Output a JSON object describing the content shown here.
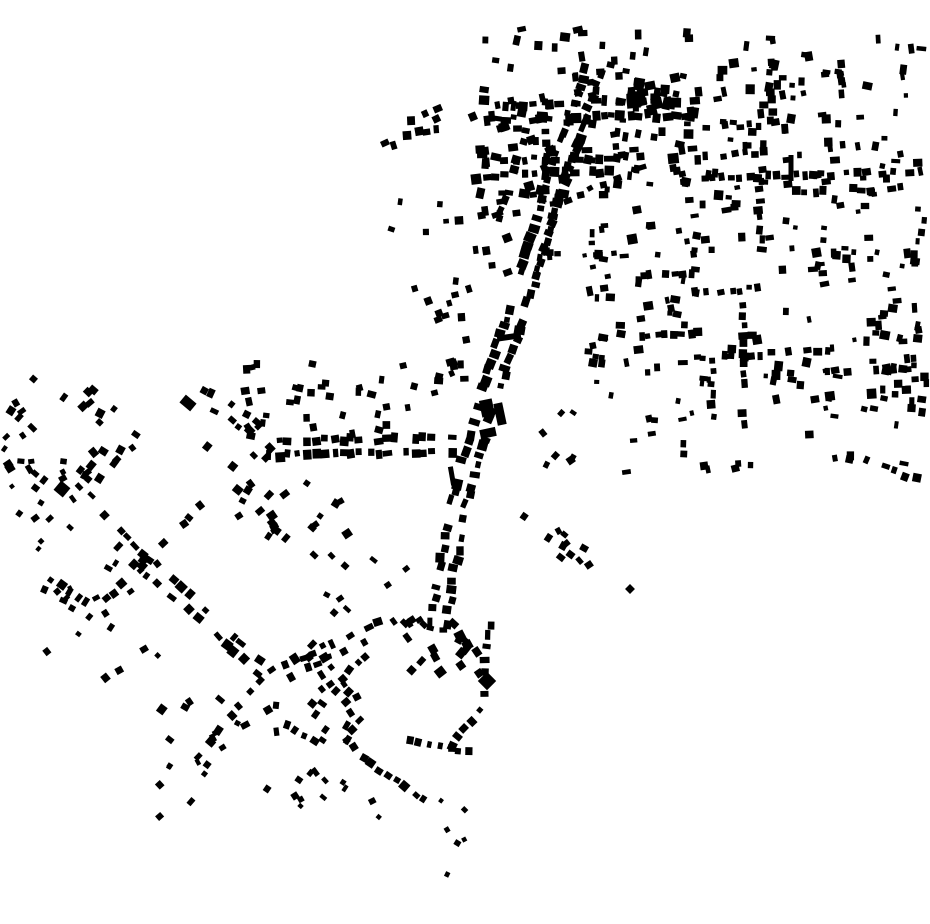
{
  "canvas": {
    "width": 930,
    "height": 924,
    "background_color": "#ffffff",
    "building_color": "#000000"
  },
  "map_type": "building-footprint-figure-ground",
  "seed": 42,
  "streets": [
    {
      "name": "main-road-1",
      "p": [
        594,
        66,
        565,
        152
      ],
      "gap": 9.5,
      "off": 8,
      "oj": 2.5,
      "sides": 2,
      "size": [
        5,
        11
      ],
      "aj": 9,
      "skip": 0.12
    },
    {
      "name": "main-road-2",
      "p": [
        565,
        152,
        524,
        288
      ],
      "gap": 9.5,
      "off": 8,
      "oj": 2.5,
      "sides": 2,
      "size": [
        5,
        11
      ],
      "aj": 9,
      "skip": 0.12
    },
    {
      "name": "main-road-3",
      "p": [
        524,
        288,
        487,
        402
      ],
      "gap": 9.5,
      "off": 8,
      "oj": 2.5,
      "sides": 2,
      "size": [
        5,
        11
      ],
      "aj": 9,
      "skip": 0.12
    },
    {
      "name": "main-road-4",
      "p": [
        487,
        402,
        456,
        512
      ],
      "gap": 10,
      "off": 8,
      "oj": 2.5,
      "sides": 2,
      "size": [
        5,
        11
      ],
      "aj": 9,
      "skip": 0.14
    },
    {
      "name": "main-road-5",
      "p": [
        456,
        512,
        436,
        645
      ],
      "gap": 10.5,
      "off": 7.5,
      "oj": 2.5,
      "sides": 2,
      "size": [
        5,
        10
      ],
      "aj": 9,
      "skip": 0.18
    },
    {
      "name": "parallel-road-east",
      "p": [
        588,
        132,
        537,
        298
      ],
      "gap": 12,
      "off": 7,
      "oj": 2,
      "sides": 1,
      "size": [
        5,
        10
      ],
      "aj": 10,
      "skip": 0.28
    },
    {
      "name": "parallel-road-west",
      "p": [
        533,
        130,
        503,
        228
      ],
      "gap": 10,
      "off": 6,
      "oj": 2,
      "sides": 1,
      "size": [
        5,
        9
      ],
      "aj": 10,
      "skip": 0.25
    },
    {
      "name": "branch-northeast",
      "p": [
        560,
        196,
        648,
        160
      ],
      "gap": 13,
      "off": 6,
      "oj": 2,
      "sides": 1,
      "size": [
        5,
        9
      ],
      "aj": 10,
      "skip": 0.3
    },
    {
      "name": "top-row-1",
      "p": [
        482,
        112,
        700,
        108
      ],
      "gap": 9,
      "off": 7,
      "oj": 2.5,
      "sides": 2,
      "size": [
        5,
        11
      ],
      "aj": 10,
      "skip": 0.22
    },
    {
      "name": "top-row-2",
      "p": [
        482,
        168,
        622,
        164
      ],
      "gap": 9.5,
      "off": 7,
      "oj": 2.5,
      "sides": 2,
      "size": [
        5,
        10
      ],
      "aj": 10,
      "skip": 0.25
    },
    {
      "name": "ne-row-1",
      "p": [
        703,
        123,
        762,
        119
      ],
      "gap": 8.5,
      "off": 5,
      "oj": 2,
      "sides": 1,
      "size": [
        4,
        8
      ],
      "aj": 8,
      "skip": 0.1
    },
    {
      "name": "ne-row-2",
      "p": [
        700,
        151,
        772,
        147
      ],
      "gap": 10,
      "off": 5,
      "oj": 2,
      "sides": 1,
      "size": [
        5,
        9
      ],
      "aj": 8,
      "skip": 0.25
    },
    {
      "name": "ne-row-long",
      "p": [
        700,
        172,
        928,
        166
      ],
      "gap": 9,
      "off": 6,
      "oj": 2,
      "sides": 1,
      "size": [
        5,
        9
      ],
      "aj": 8,
      "skip": 0.18
    },
    {
      "name": "ne-row-3",
      "p": [
        790,
        187,
        908,
        183
      ],
      "gap": 9.5,
      "off": 5,
      "oj": 2,
      "sides": 1,
      "size": [
        5,
        9
      ],
      "aj": 8,
      "skip": 0.25
    },
    {
      "name": "e-row-1",
      "p": [
        637,
        271,
        704,
        267
      ],
      "gap": 8.5,
      "off": 5,
      "oj": 2,
      "sides": 1,
      "size": [
        5,
        9
      ],
      "aj": 8,
      "skip": 0.12
    },
    {
      "name": "e-row-2",
      "p": [
        718,
        286,
        764,
        283
      ],
      "gap": 9,
      "off": 5,
      "oj": 2,
      "sides": 1,
      "size": [
        5,
        9
      ],
      "aj": 8,
      "skip": 0.2
    },
    {
      "name": "e-row-3",
      "p": [
        636,
        331,
        708,
        328
      ],
      "gap": 8.5,
      "off": 5,
      "oj": 2,
      "sides": 1,
      "size": [
        5,
        9
      ],
      "aj": 8,
      "skip": 0.12
    },
    {
      "name": "e-row-4",
      "p": [
        700,
        352,
        850,
        345
      ],
      "gap": 9.5,
      "off": 5,
      "oj": 2,
      "sides": 1,
      "size": [
        5,
        9
      ],
      "aj": 8,
      "skip": 0.3
    },
    {
      "name": "e-row-5",
      "p": [
        820,
        368,
        928,
        361
      ],
      "gap": 10,
      "off": 5,
      "oj": 2,
      "sides": 1,
      "size": [
        5,
        9
      ],
      "aj": 8,
      "skip": 0.35
    },
    {
      "name": "se-diagonal",
      "p": [
        852,
        450,
        928,
        478
      ],
      "gap": 10.5,
      "off": 5,
      "oj": 2,
      "sides": 1,
      "size": [
        5,
        9
      ],
      "aj": 10,
      "skip": 0.2
    },
    {
      "name": "ne-col-1",
      "p": [
        776,
        58,
        776,
        132
      ],
      "gap": 9.5,
      "off": 5,
      "oj": 2,
      "sides": 1,
      "size": [
        5,
        9
      ],
      "aj": 8,
      "skip": 0.2
    },
    {
      "name": "ne-col-2",
      "p": [
        766,
        166,
        766,
        242
      ],
      "gap": 9.5,
      "off": 5,
      "oj": 2,
      "sides": 1,
      "size": [
        5,
        9
      ],
      "aj": 8,
      "skip": 0.2
    },
    {
      "name": "e-col-1",
      "p": [
        748,
        300,
        748,
        438
      ],
      "gap": 10,
      "off": 5,
      "oj": 2,
      "sides": 1,
      "size": [
        5,
        9
      ],
      "aj": 8,
      "skip": 0.25
    },
    {
      "name": "e-col-2",
      "p": [
        718,
        346,
        718,
        430
      ],
      "gap": 10.5,
      "off": 5,
      "oj": 2,
      "sides": 1,
      "size": [
        5,
        9
      ],
      "aj": 8,
      "skip": 0.3
    },
    {
      "name": "ne-col-3",
      "p": [
        845,
        58,
        845,
        133
      ],
      "gap": 10,
      "off": 5,
      "oj": 2,
      "sides": 1,
      "size": [
        5,
        9
      ],
      "aj": 8,
      "skip": 0.3
    },
    {
      "name": "e-edge-col",
      "p": [
        920,
        205,
        920,
        284
      ],
      "gap": 11,
      "off": 4,
      "oj": 2,
      "sides": 1,
      "size": [
        4,
        8
      ],
      "aj": 8,
      "skip": 0.3
    },
    {
      "name": "sw-main-diagonal",
      "p": [
        95,
        518,
        272,
        678
      ],
      "gap": 10.5,
      "off": 6.5,
      "oj": 2,
      "sides": 2,
      "size": [
        5,
        10
      ],
      "aj": 10,
      "skip": 0.2
    },
    {
      "name": "sw-cross-street",
      "p": [
        208,
        508,
        92,
        622
      ],
      "gap": 12,
      "off": 6,
      "oj": 2,
      "sides": 1,
      "size": [
        5,
        9
      ],
      "aj": 10,
      "skip": 0.3
    },
    {
      "name": "sw-short-street",
      "p": [
        44,
        582,
        98,
        617
      ],
      "gap": 10.5,
      "off": 6,
      "oj": 2,
      "sides": 2,
      "size": [
        5,
        9
      ],
      "aj": 10,
      "skip": 0.3
    },
    {
      "name": "sw-arm-northeast",
      "p": [
        272,
        678,
        395,
        620
      ],
      "gap": 10.5,
      "off": 6,
      "oj": 2,
      "sides": 2,
      "size": [
        5,
        10
      ],
      "aj": 10,
      "skip": 0.3
    },
    {
      "name": "sw-arm-south",
      "p": [
        268,
        682,
        196,
        768
      ],
      "gap": 11,
      "off": 6,
      "oj": 2,
      "sides": 1,
      "size": [
        5,
        9
      ],
      "aj": 10,
      "skip": 0.25
    },
    {
      "name": "sw-arm-down",
      "p": [
        279,
        700,
        283,
        758
      ],
      "gap": 12,
      "off": 5,
      "oj": 2,
      "sides": 1,
      "size": [
        5,
        9
      ],
      "aj": 12,
      "skip": 0.3
    },
    {
      "name": "sw-x-street-a",
      "p": [
        303,
        642,
        362,
        715
      ],
      "gap": 11,
      "off": 6,
      "oj": 2,
      "sides": 2,
      "size": [
        5,
        9
      ],
      "aj": 10,
      "skip": 0.35
    },
    {
      "name": "sw-x-street-b",
      "p": [
        306,
        714,
        365,
        645
      ],
      "gap": 11,
      "off": 6,
      "oj": 2,
      "sides": 1,
      "size": [
        5,
        9
      ],
      "aj": 10,
      "skip": 0.3
    },
    {
      "name": "sw-arm-southeast",
      "p": [
        285,
        718,
        350,
        752
      ],
      "gap": 11,
      "off": 5,
      "oj": 2,
      "sides": 1,
      "size": [
        5,
        9
      ],
      "aj": 10,
      "skip": 0.3
    },
    {
      "name": "midleft-street-a",
      "p": [
        196,
        390,
        262,
        434
      ],
      "gap": 10.5,
      "off": 6,
      "oj": 2,
      "sides": 2,
      "size": [
        5,
        9
      ],
      "aj": 10,
      "skip": 0.3
    },
    {
      "name": "midleft-street-b",
      "p": [
        235,
        480,
        318,
        562
      ],
      "gap": 12,
      "off": 6,
      "oj": 2,
      "sides": 1,
      "size": [
        5,
        9
      ],
      "aj": 10,
      "skip": 0.3
    },
    {
      "name": "central-horizontal-street",
      "p": [
        266,
        449,
        458,
        444
      ],
      "gap": 9,
      "off": 7,
      "oj": 2.5,
      "sides": 2,
      "size": [
        5,
        10
      ],
      "aj": 8,
      "skip": 0.15
    },
    {
      "name": "south-tail-1",
      "p": [
        497,
        618,
        487,
        708
      ],
      "gap": 12,
      "off": 6,
      "oj": 2,
      "sides": 1,
      "size": [
        5,
        10
      ],
      "aj": 12,
      "skip": 0.2
    },
    {
      "name": "south-tail-2",
      "p": [
        487,
        708,
        452,
        758
      ],
      "gap": 12,
      "off": 6,
      "oj": 2,
      "sides": 1,
      "size": [
        5,
        9
      ],
      "aj": 12,
      "skip": 0.25
    },
    {
      "name": "south-row",
      "p": [
        406,
        736,
        476,
        748
      ],
      "gap": 10,
      "off": 5,
      "oj": 2,
      "sides": 1,
      "size": [
        4,
        8
      ],
      "aj": 12,
      "skip": 0.25
    },
    {
      "name": "south-diagonal",
      "p": [
        362,
        750,
        430,
        800
      ],
      "gap": 10.5,
      "off": 5,
      "oj": 2,
      "sides": 1,
      "size": [
        5,
        9
      ],
      "aj": 10,
      "skip": 0.25
    },
    {
      "name": "southeast-spur",
      "p": [
        523,
        507,
        594,
        566
      ],
      "gap": 12,
      "off": 6,
      "oj": 2,
      "sides": 1,
      "size": [
        5,
        8
      ],
      "aj": 12,
      "skip": 0.3
    },
    {
      "name": "west-small-row",
      "p": [
        16,
        458,
        92,
        455
      ],
      "gap": 11,
      "off": 4,
      "oj": 2,
      "sides": 1,
      "size": [
        4,
        8
      ],
      "aj": 14,
      "skip": 0.2
    }
  ],
  "fields": [
    {
      "name": "top-scatter",
      "box": [
        470,
        28,
        245,
        68
      ],
      "n": 34,
      "size": [
        5,
        10
      ],
      "a": 0,
      "aj": 14
    },
    {
      "name": "top-cluster-infill",
      "box": [
        474,
        94,
        236,
        110
      ],
      "n": 48,
      "size": [
        5,
        11
      ],
      "a": 0,
      "aj": 14
    },
    {
      "name": "top-dense-blob",
      "box": [
        627,
        80,
        44,
        38
      ],
      "n": 16,
      "size": [
        6,
        12
      ],
      "a": 0,
      "aj": 14
    },
    {
      "name": "nw-outlier-cluster",
      "box": [
        376,
        106,
        62,
        46
      ],
      "n": 10,
      "size": [
        5,
        9
      ],
      "a": -15,
      "aj": 14
    },
    {
      "name": "nw-sparse-dots",
      "box": [
        372,
        195,
        88,
        95
      ],
      "n": 7,
      "size": [
        4,
        8
      ],
      "a": 0,
      "aj": 20
    },
    {
      "name": "right-field-upper",
      "box": [
        588,
        36,
        340,
        222
      ],
      "n": 150,
      "size": [
        4,
        10
      ],
      "a": 0,
      "aj": 12
    },
    {
      "name": "right-field-mid",
      "box": [
        588,
        258,
        340,
        145
      ],
      "n": 105,
      "size": [
        4,
        10
      ],
      "a": 0,
      "aj": 12
    },
    {
      "name": "right-field-lower",
      "box": [
        620,
        403,
        308,
        70
      ],
      "n": 26,
      "size": [
        4,
        9
      ],
      "a": 0,
      "aj": 15
    },
    {
      "name": "right-edge-cluster",
      "box": [
        880,
        338,
        50,
        58
      ],
      "n": 12,
      "size": [
        5,
        9
      ],
      "a": 5,
      "aj": 12
    },
    {
      "name": "road-west-upper",
      "box": [
        468,
        92,
        92,
        122
      ],
      "n": 26,
      "size": [
        5,
        10
      ],
      "a": -12,
      "aj": 12
    },
    {
      "name": "road-west-shoulder",
      "box": [
        458,
        215,
        50,
        82
      ],
      "n": 10,
      "size": [
        5,
        9
      ],
      "a": -12,
      "aj": 12
    },
    {
      "name": "road-east-sparse",
      "box": [
        545,
        210,
        58,
        82
      ],
      "n": 8,
      "size": [
        4,
        8
      ],
      "a": -10,
      "aj": 12
    },
    {
      "name": "road-west-mid",
      "box": [
        424,
        292,
        64,
        90
      ],
      "n": 14,
      "size": [
        5,
        9
      ],
      "a": -12,
      "aj": 12
    },
    {
      "name": "road-east-dots",
      "box": [
        532,
        412,
        54,
        60
      ],
      "n": 7,
      "size": [
        4,
        8
      ],
      "a": 45,
      "aj": 20
    },
    {
      "name": "spur-end-cluster",
      "box": [
        548,
        520,
        44,
        46
      ],
      "n": 6,
      "size": [
        5,
        8
      ],
      "a": 45,
      "aj": 18
    },
    {
      "name": "west-cluster",
      "box": [
        0,
        378,
        148,
        104
      ],
      "n": 30,
      "size": [
        5,
        9
      ],
      "a": 45,
      "aj": 18
    },
    {
      "name": "west-edge-dots",
      "box": [
        0,
        430,
        26,
        96
      ],
      "n": 5,
      "size": [
        4,
        7
      ],
      "a": 45,
      "aj": 18
    },
    {
      "name": "west-connector",
      "box": [
        30,
        468,
        72,
        58
      ],
      "n": 8,
      "size": [
        5,
        8
      ],
      "a": 45,
      "aj": 18
    },
    {
      "name": "west-lower-dots",
      "box": [
        0,
        490,
        92,
        72
      ],
      "n": 6,
      "size": [
        4,
        8
      ],
      "a": 45,
      "aj": 18
    },
    {
      "name": "midleft-field-a",
      "box": [
        195,
        425,
        78,
        96
      ],
      "n": 13,
      "size": [
        5,
        9
      ],
      "a": 45,
      "aj": 18
    },
    {
      "name": "midleft-field-b",
      "box": [
        268,
        468,
        80,
        104
      ],
      "n": 15,
      "size": [
        5,
        9
      ],
      "a": 45,
      "aj": 18
    },
    {
      "name": "central-street-north-scatter",
      "box": [
        245,
        362,
        215,
        74
      ],
      "n": 36,
      "size": [
        5,
        9
      ],
      "a": 0,
      "aj": 16
    },
    {
      "name": "center-south-sparse",
      "box": [
        300,
        548,
        128,
        76
      ],
      "n": 8,
      "size": [
        4,
        8
      ],
      "a": 45,
      "aj": 18
    },
    {
      "name": "sw-upper-scatter",
      "box": [
        40,
        555,
        120,
        130
      ],
      "n": 16,
      "size": [
        4,
        8
      ],
      "a": 45,
      "aj": 18
    },
    {
      "name": "sw-lower-scatter-a",
      "box": [
        150,
        688,
        132,
        104
      ],
      "n": 14,
      "size": [
        5,
        9
      ],
      "a": 45,
      "aj": 18
    },
    {
      "name": "sw-lower-scatter-b",
      "box": [
        283,
        688,
        90,
        92
      ],
      "n": 15,
      "size": [
        5,
        9
      ],
      "a": 45,
      "aj": 18
    },
    {
      "name": "sw-bottom-dots-a",
      "box": [
        150,
        755,
        78,
        62
      ],
      "n": 7,
      "size": [
        4,
        8
      ],
      "a": 45,
      "aj": 18
    },
    {
      "name": "sw-bottom-dots-b",
      "box": [
        288,
        780,
        60,
        32
      ],
      "n": 5,
      "size": [
        4,
        7
      ],
      "a": 45,
      "aj": 18
    },
    {
      "name": "south-crossroads-cluster",
      "box": [
        392,
        616,
        88,
        58
      ],
      "n": 22,
      "size": [
        5,
        10
      ],
      "a": 45,
      "aj": 18
    },
    {
      "name": "south-tail-dots",
      "box": [
        425,
        788,
        45,
        90
      ],
      "n": 6,
      "size": [
        4,
        7
      ],
      "a": 45,
      "aj": 20
    },
    {
      "name": "south-tail-dots-west",
      "box": [
        330,
        780,
        50,
        48
      ],
      "n": 4,
      "size": [
        4,
        7
      ],
      "a": 45,
      "aj": 20
    }
  ],
  "landmarks": [
    {
      "name": "large-building-a",
      "x": 487,
      "y": 408,
      "w": 13,
      "h": 17,
      "a": -12
    },
    {
      "name": "large-building-b",
      "x": 500,
      "y": 414,
      "w": 9,
      "h": 22,
      "a": -12
    },
    {
      "name": "large-building-c",
      "x": 488,
      "y": 433,
      "w": 16,
      "h": 9,
      "a": -12
    },
    {
      "name": "long-thin-building",
      "x": 509,
      "y": 337,
      "w": 24,
      "h": 6,
      "a": -8
    },
    {
      "name": "thin-vertical-building-road",
      "x": 452,
      "y": 476,
      "w": 5,
      "h": 19,
      "a": -10
    },
    {
      "name": "thin-vertical-building-east",
      "x": 791,
      "y": 168,
      "w": 5,
      "h": 26,
      "a": 0
    },
    {
      "name": "big-diamond-south",
      "x": 487,
      "y": 681,
      "w": 13,
      "h": 13,
      "a": 45
    },
    {
      "name": "isolated-dot-east",
      "x": 630,
      "y": 589,
      "w": 7,
      "h": 7,
      "a": 45
    },
    {
      "name": "large-west-building",
      "x": 62,
      "y": 489,
      "w": 12,
      "h": 12,
      "a": 40
    },
    {
      "name": "large-midleft-building",
      "x": 188,
      "y": 403,
      "w": 14,
      "h": 10,
      "a": 40
    }
  ]
}
